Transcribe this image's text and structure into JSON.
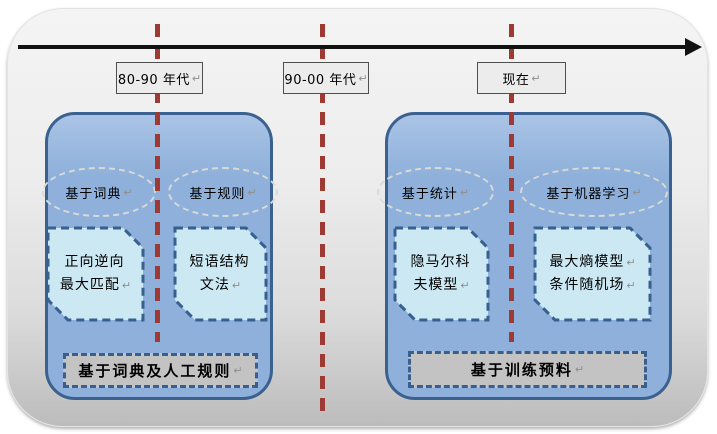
{
  "timeline": {
    "eras": [
      {
        "label": "80-90 年代",
        "mark": "↵"
      },
      {
        "label": "90-00 年代",
        "mark": "↵"
      },
      {
        "label": "现在",
        "mark": "↵"
      }
    ]
  },
  "groups": [
    {
      "approaches": [
        {
          "label": "基于词典",
          "mark": "↵"
        },
        {
          "label": "基于规则",
          "mark": "↵"
        }
      ],
      "methods": [
        {
          "lines": [
            {
              "text": "正向逆向",
              "mark": ""
            },
            {
              "text": "最大匹配",
              "mark": "↵"
            }
          ]
        },
        {
          "lines": [
            {
              "text": "短语结构",
              "mark": ""
            },
            {
              "text": "文法",
              "mark": "↵"
            }
          ]
        }
      ],
      "caption": {
        "label": "基于词典及人工规则",
        "mark": "↵"
      }
    },
    {
      "approaches": [
        {
          "label": "基于统计",
          "mark": "↵"
        },
        {
          "label": "基于机器学习",
          "mark": "↵"
        }
      ],
      "methods": [
        {
          "lines": [
            {
              "text": "隐马尔科",
              "mark": ""
            },
            {
              "text": "夫模型",
              "mark": "↵"
            }
          ]
        },
        {
          "lines": [
            {
              "text": "最大熵模型",
              "mark": "↵"
            },
            {
              "text": "条件随机场",
              "mark": "↵"
            }
          ]
        }
      ],
      "caption": {
        "label": "基于训练预料",
        "mark": "↵"
      }
    }
  ],
  "colors": {
    "era_divider": "#9e3a33",
    "group_fill": "#8eb0da",
    "group_border": "#3a618f",
    "method_fill": "#cbe8f3",
    "method_border": "#36608f",
    "caption_fill": "#c3c3c3",
    "era_label_fill": "#ececec",
    "timeline_arrow": "#121212"
  }
}
